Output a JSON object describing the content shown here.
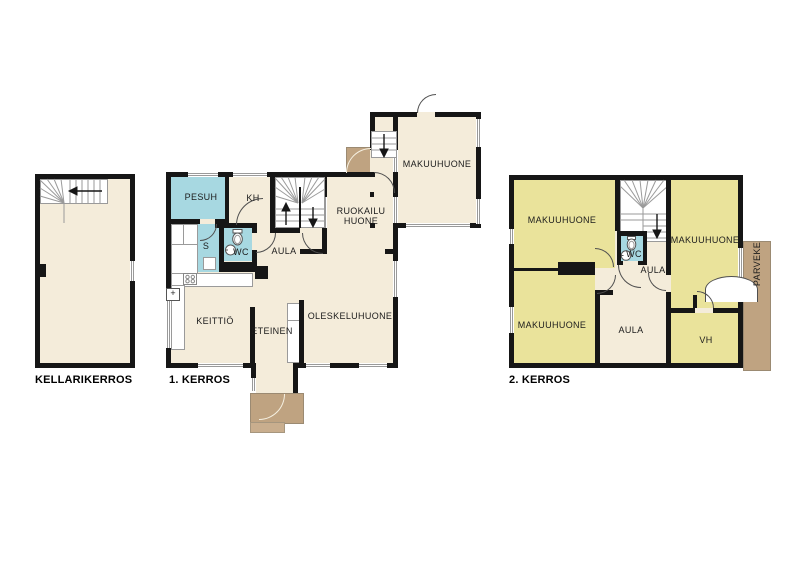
{
  "palette": {
    "cream": "#f4ecda",
    "blue": "#a7d8e1",
    "yellow": "#eae39b",
    "brown": "#bfa381",
    "brown_light": "#c9ae8e",
    "wall": "#161616",
    "window_line": "#9a9a9a"
  },
  "basement": {
    "label": "KELLARIKERROS"
  },
  "floor1": {
    "label": "1. KERROS",
    "rooms": {
      "pesuh": "PESUH",
      "kh": "KH",
      "sauna": "S",
      "wc": "WC",
      "aula": "AULA",
      "ruokailu_line1": "RUOKAILU",
      "ruokailu_line2": "HUONE",
      "makuuhuone": "MAKUUHUONE",
      "keittio": "KEITTIÖ",
      "eteinen": "ETEINEN",
      "oleskeluhuone": "OLESKELUHUONE"
    },
    "symbols": {
      "plus": "+"
    }
  },
  "floor2": {
    "label": "2. KERROS",
    "rooms": {
      "makuuhuone_tl": "MAKUUHUONE",
      "makuuhuone_tr": "MAKUUHUONE",
      "makuuhuone_bl": "MAKUUHUONE",
      "wc": "WC",
      "aula_upper": "AULA",
      "aula": "AULA",
      "vh": "VH",
      "parveke": "PARVEKE"
    }
  }
}
